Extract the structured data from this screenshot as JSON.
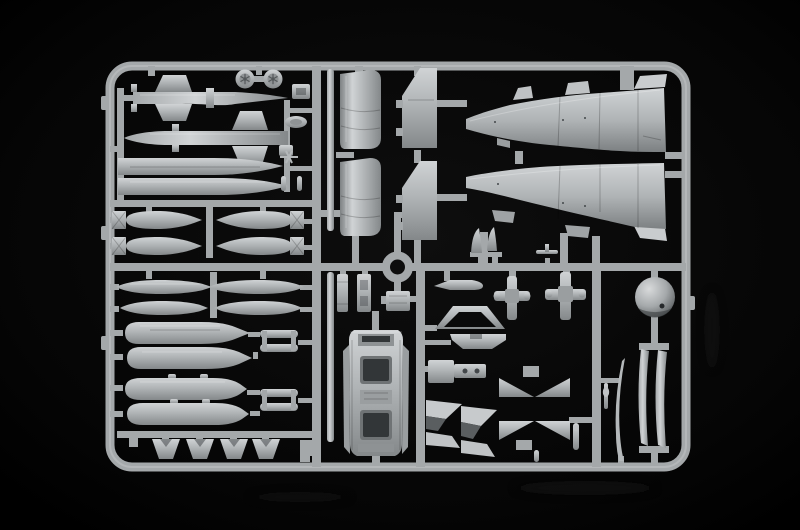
{
  "meta": {
    "description": "Photograph of a light-grey injection-moulded plastic model kit sprue (aircraft parts frame) lying on a black background. The rectangular runner frame holds fuselage halves, missiles, drop tanks, bombs, ejector racks, a two-seat cockpit tub, engine duct halves, intake ramps, a radome ball, wheels, fins and many small detail parts."
  },
  "colors": {
    "background": "#050505",
    "vignette": "#0e0e0e",
    "runner": "#a4a8aa",
    "runner_light": "#bcc0c2",
    "plastic": "#b0b4b6",
    "plastic_bright": "#d0d3d5",
    "plastic_mid": "#a5a9ab",
    "plastic_dark": "#84888a",
    "plastic_deep": "#43474a",
    "well_dark": "#323638",
    "ball_bright": "#d8dadb",
    "ball_dark": "#4e5254",
    "reflection": "#161616"
  },
  "parts": [
    {
      "name": "anti-ship missile with delta fins",
      "qty": 2
    },
    {
      "name": "slender drop tank half",
      "qty": 2
    },
    {
      "name": "main wheel",
      "qty": 2
    },
    {
      "name": "bomb with box tail fins",
      "qty": 4
    },
    {
      "name": "slim bomb body",
      "qty": 4
    },
    {
      "name": "triple ejector rack",
      "qty": 2
    },
    {
      "name": "large fuel tank",
      "qty": 2
    },
    {
      "name": "large bomb with suspension lugs",
      "qty": 2
    },
    {
      "name": "trapezoid fin",
      "qty": 4
    },
    {
      "name": "engine duct half",
      "qty": 2
    },
    {
      "name": "inner flap panel",
      "qty": 2
    },
    {
      "name": "fuselage half",
      "qty": 2
    },
    {
      "name": "two-seat cockpit tub",
      "qty": 1
    },
    {
      "name": "side console strip",
      "qty": 2
    },
    {
      "name": "equipment block",
      "qty": 1
    },
    {
      "name": "windscreen frame",
      "qty": 1
    },
    {
      "name": "canopy base",
      "qty": 1
    },
    {
      "name": "blade antenna",
      "qty": 1
    },
    {
      "name": "landing gear cross part",
      "qty": 2
    },
    {
      "name": "intake ramp wedge",
      "qty": 2
    },
    {
      "name": "cruciform fin cluster",
      "qty": 1
    },
    {
      "name": "radome ball",
      "qty": 1
    },
    {
      "name": "canopy sill blade",
      "qty": 2
    },
    {
      "name": "refueling probe",
      "qty": 1
    },
    {
      "name": "pitot boom",
      "qty": 1
    },
    {
      "name": "long thin strip",
      "qty": 2
    }
  ]
}
